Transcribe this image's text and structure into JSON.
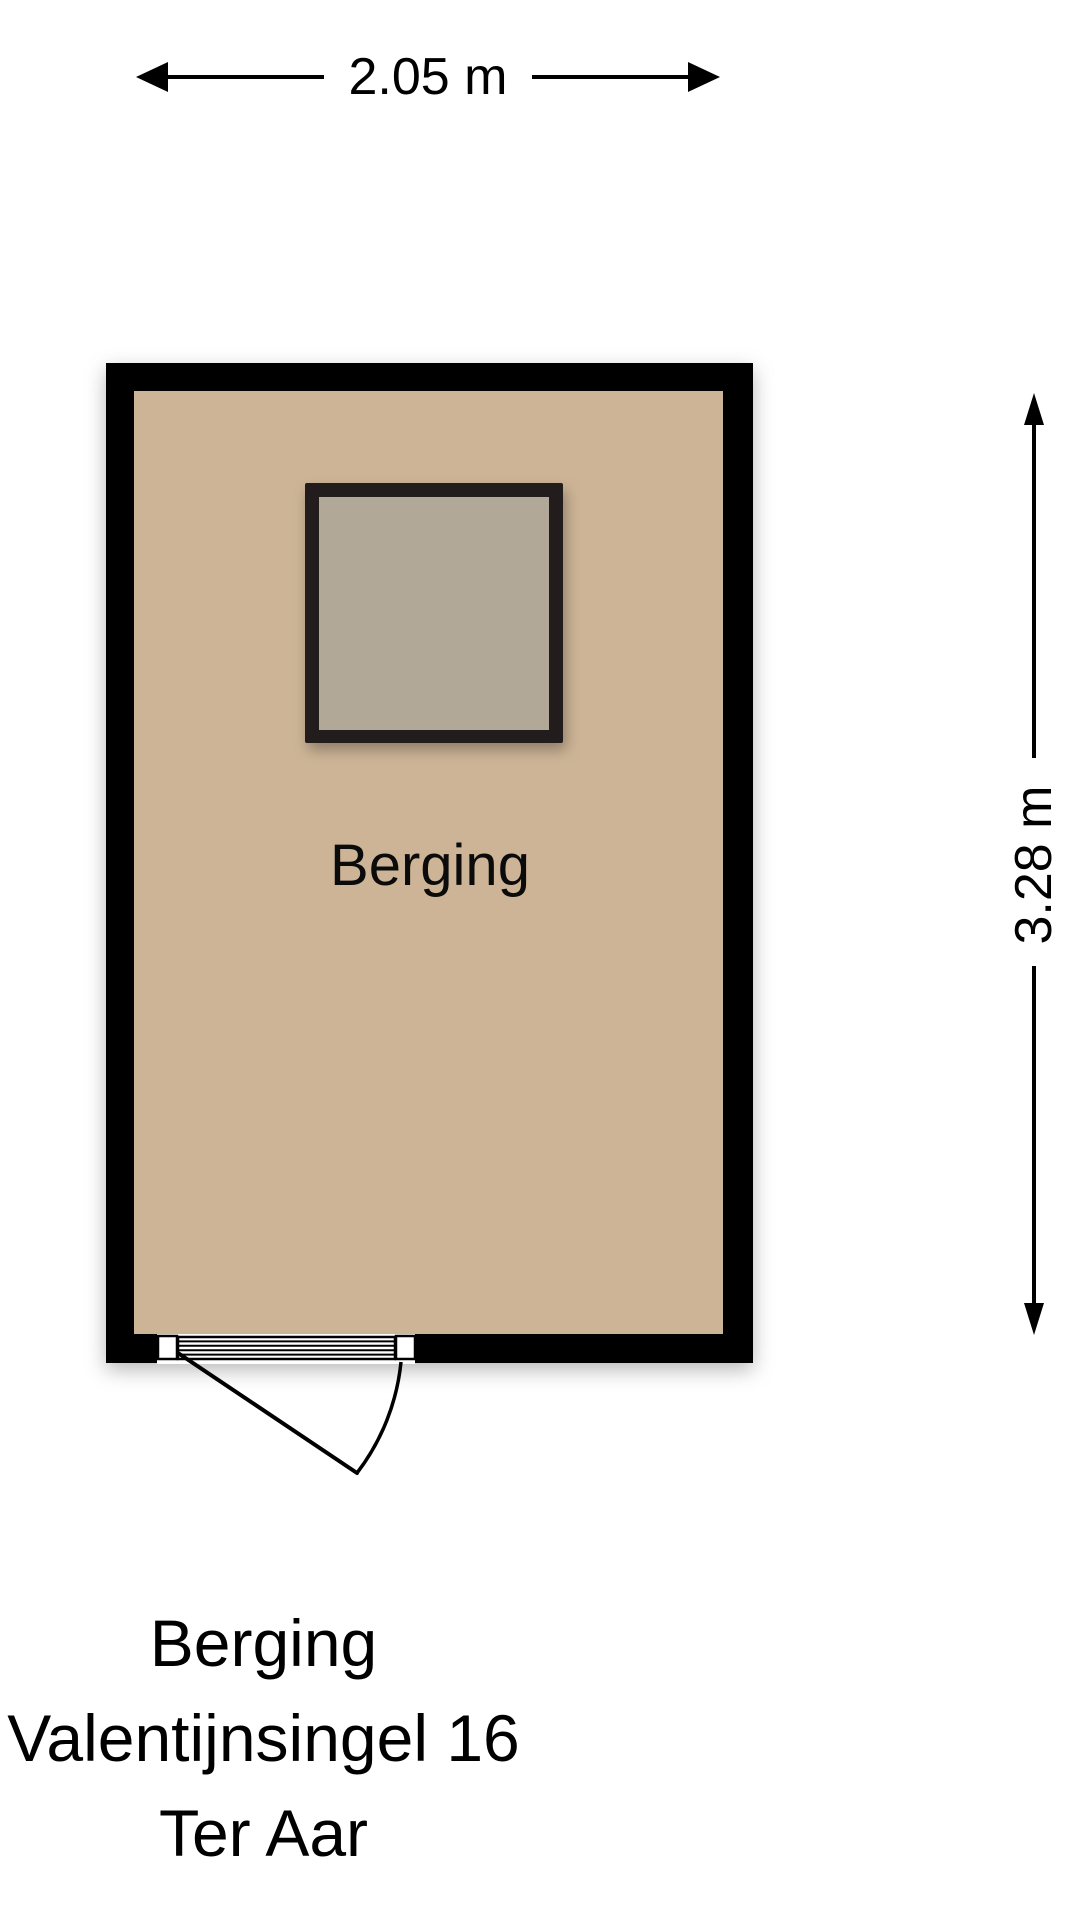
{
  "floorplan": {
    "room_label": "Berging",
    "width_dimension": "2.05 m",
    "height_dimension": "3.28 m",
    "colors": {
      "wall": "#000000",
      "floor": "#cdb496",
      "skylight_frame": "#221f1c",
      "skylight_glass": "#b2a897",
      "dimension": "#000000",
      "background": "#ffffff"
    }
  },
  "title_block": {
    "line1": "Berging",
    "line2": "Valentijnsingel 16",
    "line3": "Ter Aar"
  }
}
